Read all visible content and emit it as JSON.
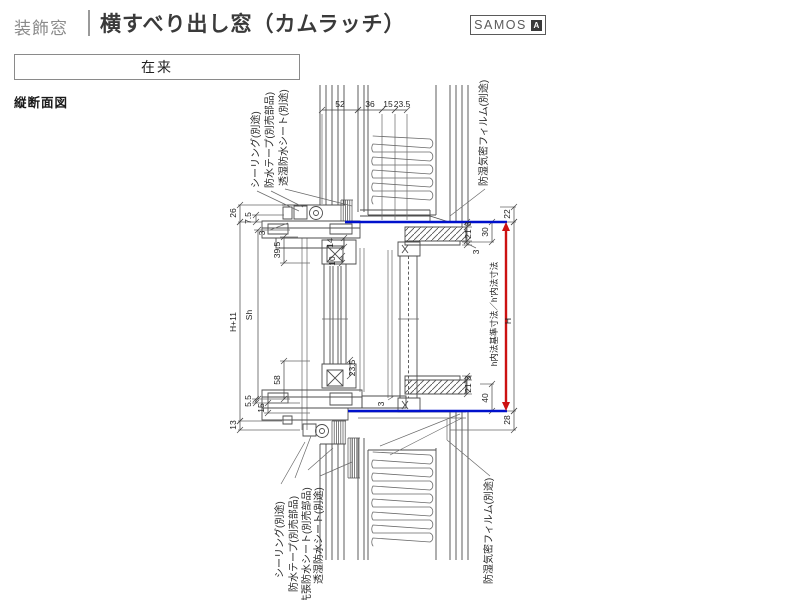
{
  "header": {
    "category_label": "装飾窓",
    "title": "横すべり出し窓（カムラッチ）",
    "brand_name": "SAMOS",
    "brand_badge": "A"
  },
  "construction_type_box": {
    "label": "在来"
  },
  "drawing": {
    "view_label": "縦断面図",
    "annotations_top": [
      "シーリング(別途)",
      "防水テープ(別売部品)",
      "透湿防水シート(別途)",
      "防湿気密フィルム(別途)"
    ],
    "annotations_bottom": [
      "シーリング(別途)",
      "防水テープ(別売部品)",
      "先張防水シート(別売部品)",
      "透湿防水シート(別途)",
      "防湿気密フィルム(別途)"
    ],
    "reference_label": "h内法基準寸法／h'内法寸法",
    "dims": {
      "top": {
        "d52": "52",
        "d36": "36",
        "d15": "15",
        "d23_5": "23.5"
      },
      "left": {
        "d26": "26",
        "d7_5": "7.5",
        "d3": "3",
        "d39_5": "39.5",
        "dSh": "Sh",
        "dH11": "H+11",
        "d58": "58",
        "d5_5": "5.5",
        "d15": "15",
        "d13": "13"
      },
      "mid": {
        "d14": "14",
        "d10": "10",
        "d23_5": "23.5",
        "d3": "3"
      },
      "right": {
        "d22": "22",
        "d30": "30",
        "d3a": "3",
        "d21a": "21",
        "d3b": "3",
        "d21b": "21",
        "d3c": "3",
        "d40": "40",
        "d28": "28",
        "dH": "H"
      }
    },
    "colors": {
      "reference_line": "#0011cc",
      "reference_arrow": "#cc1111"
    }
  }
}
